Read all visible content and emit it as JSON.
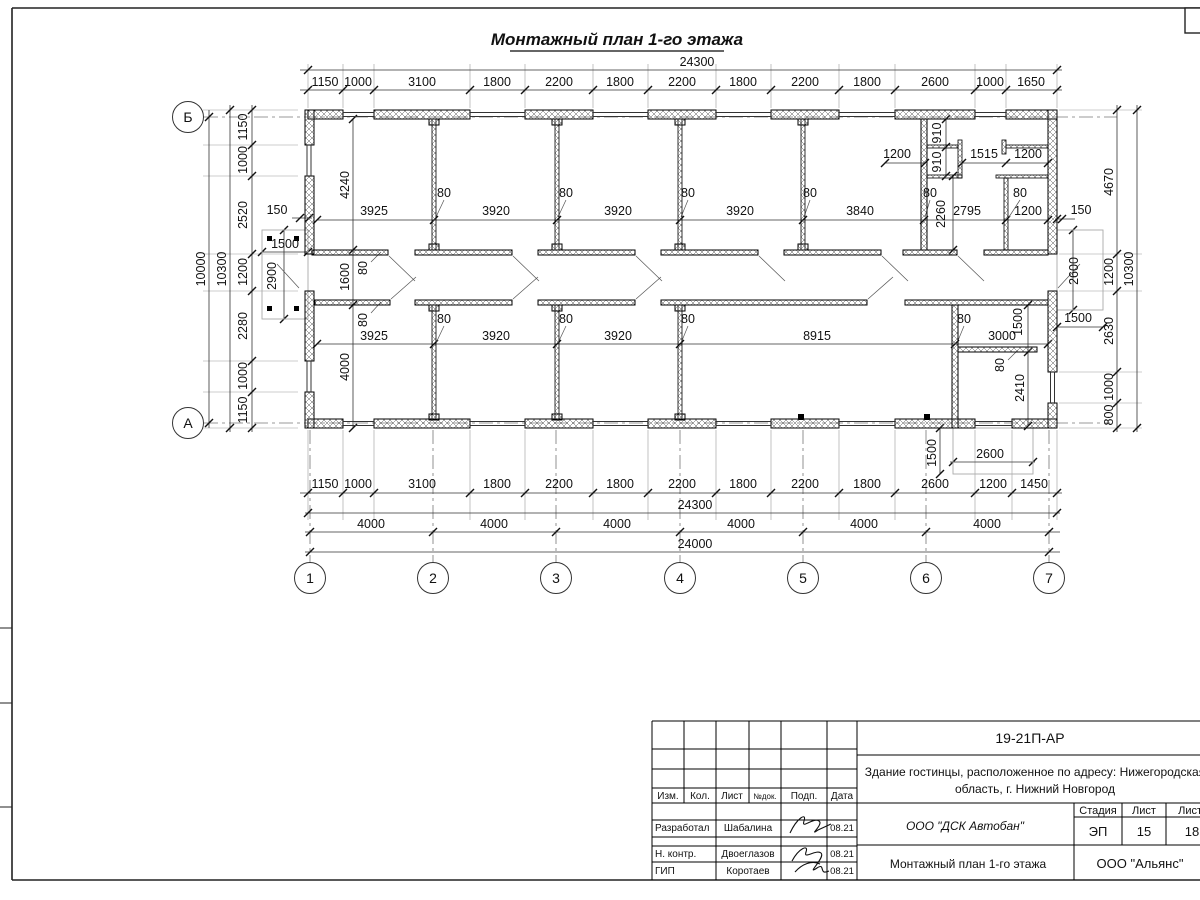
{
  "title": "Монтажный план 1-го этажа",
  "axes": {
    "cols": [
      "1",
      "2",
      "3",
      "4",
      "5",
      "6",
      "7"
    ],
    "rows": [
      "Б",
      "А"
    ]
  },
  "dims": {
    "labels": [
      {
        "t": "24300",
        "x": 697,
        "y": 66
      },
      {
        "t": "1150",
        "x": 325,
        "y": 86
      },
      {
        "t": "1000",
        "x": 358,
        "y": 86
      },
      {
        "t": "3100",
        "x": 422,
        "y": 86
      },
      {
        "t": "1800",
        "x": 497,
        "y": 86
      },
      {
        "t": "2200",
        "x": 559,
        "y": 86
      },
      {
        "t": "1800",
        "x": 620,
        "y": 86
      },
      {
        "t": "2200",
        "x": 682,
        "y": 86
      },
      {
        "t": "1800",
        "x": 743,
        "y": 86
      },
      {
        "t": "2200",
        "x": 805,
        "y": 86
      },
      {
        "t": "1800",
        "x": 867,
        "y": 86
      },
      {
        "t": "2600",
        "x": 935,
        "y": 86
      },
      {
        "t": "1000",
        "x": 990,
        "y": 86
      },
      {
        "t": "1650",
        "x": 1031,
        "y": 86
      },
      {
        "t": "1150",
        "x": 325,
        "y": 488
      },
      {
        "t": "1000",
        "x": 358,
        "y": 488
      },
      {
        "t": "3100",
        "x": 422,
        "y": 488
      },
      {
        "t": "1800",
        "x": 497,
        "y": 488
      },
      {
        "t": "2200",
        "x": 559,
        "y": 488
      },
      {
        "t": "1800",
        "x": 620,
        "y": 488
      },
      {
        "t": "2200",
        "x": 682,
        "y": 488
      },
      {
        "t": "1800",
        "x": 743,
        "y": 488
      },
      {
        "t": "2200",
        "x": 805,
        "y": 488
      },
      {
        "t": "1800",
        "x": 867,
        "y": 488
      },
      {
        "t": "2600",
        "x": 935,
        "y": 488
      },
      {
        "t": "1200",
        "x": 993,
        "y": 488
      },
      {
        "t": "1450",
        "x": 1034,
        "y": 488
      },
      {
        "t": "24300",
        "x": 695,
        "y": 509
      },
      {
        "t": "4000",
        "x": 371,
        "y": 528
      },
      {
        "t": "4000",
        "x": 494,
        "y": 528
      },
      {
        "t": "4000",
        "x": 617,
        "y": 528
      },
      {
        "t": "4000",
        "x": 741,
        "y": 528
      },
      {
        "t": "4000",
        "x": 864,
        "y": 528
      },
      {
        "t": "4000",
        "x": 987,
        "y": 528
      },
      {
        "t": "24000",
        "x": 695,
        "y": 548
      },
      {
        "t": "1150",
        "x": 247,
        "y": 127,
        "r": 1
      },
      {
        "t": "1000",
        "x": 247,
        "y": 160,
        "r": 1
      },
      {
        "t": "2520",
        "x": 247,
        "y": 215,
        "r": 1
      },
      {
        "t": "1200",
        "x": 247,
        "y": 272,
        "r": 1
      },
      {
        "t": "2280",
        "x": 247,
        "y": 326,
        "r": 1
      },
      {
        "t": "1000",
        "x": 247,
        "y": 376,
        "r": 1
      },
      {
        "t": "1150",
        "x": 247,
        "y": 410,
        "r": 1
      },
      {
        "t": "10300",
        "x": 226,
        "y": 269,
        "r": 1
      },
      {
        "t": "10000",
        "x": 205,
        "y": 269,
        "r": 1
      },
      {
        "t": "4670",
        "x": 1113,
        "y": 182,
        "r": 1
      },
      {
        "t": "1200",
        "x": 1113,
        "y": 272,
        "r": 1
      },
      {
        "t": "2630",
        "x": 1113,
        "y": 331,
        "r": 1
      },
      {
        "t": "1000",
        "x": 1113,
        "y": 387,
        "r": 1
      },
      {
        "t": "800",
        "x": 1113,
        "y": 415,
        "r": 1
      },
      {
        "t": "10300",
        "x": 1133,
        "y": 269,
        "r": 1
      },
      {
        "t": "4240",
        "x": 349,
        "y": 185,
        "r": 1
      },
      {
        "t": "3925",
        "x": 374,
        "y": 215
      },
      {
        "t": "80",
        "x": 444,
        "y": 197
      },
      {
        "t": "3920",
        "x": 496,
        "y": 215
      },
      {
        "t": "80",
        "x": 566,
        "y": 197
      },
      {
        "t": "3920",
        "x": 618,
        "y": 215
      },
      {
        "t": "80",
        "x": 688,
        "y": 197
      },
      {
        "t": "3920",
        "x": 740,
        "y": 215
      },
      {
        "t": "80",
        "x": 810,
        "y": 197
      },
      {
        "t": "3840",
        "x": 860,
        "y": 215
      },
      {
        "t": "80",
        "x": 930,
        "y": 197
      },
      {
        "t": "1600",
        "x": 349,
        "y": 277,
        "r": 1
      },
      {
        "t": "80",
        "x": 367,
        "y": 268,
        "r": 1
      },
      {
        "t": "80",
        "x": 367,
        "y": 320,
        "r": 1
      },
      {
        "t": "1200",
        "x": 897,
        "y": 158
      },
      {
        "t": "910",
        "x": 941,
        "y": 133,
        "r": 1
      },
      {
        "t": "910",
        "x": 941,
        "y": 162,
        "r": 1
      },
      {
        "t": "1515",
        "x": 984,
        "y": 158
      },
      {
        "t": "1200",
        "x": 1028,
        "y": 158
      },
      {
        "t": "2260",
        "x": 945,
        "y": 214,
        "r": 1
      },
      {
        "t": "2795",
        "x": 967,
        "y": 215
      },
      {
        "t": "80",
        "x": 1020,
        "y": 197
      },
      {
        "t": "1200",
        "x": 1028,
        "y": 215
      },
      {
        "t": "150",
        "x": 1081,
        "y": 214
      },
      {
        "t": "3925",
        "x": 374,
        "y": 340
      },
      {
        "t": "80",
        "x": 444,
        "y": 323
      },
      {
        "t": "3920",
        "x": 496,
        "y": 340
      },
      {
        "t": "80",
        "x": 566,
        "y": 323
      },
      {
        "t": "3920",
        "x": 618,
        "y": 340
      },
      {
        "t": "80",
        "x": 688,
        "y": 323
      },
      {
        "t": "8915",
        "x": 817,
        "y": 340
      },
      {
        "t": "80",
        "x": 964,
        "y": 323
      },
      {
        "t": "3000",
        "x": 1002,
        "y": 340
      },
      {
        "t": "4000",
        "x": 349,
        "y": 367,
        "r": 1
      },
      {
        "t": "1500",
        "x": 1022,
        "y": 322,
        "r": 1
      },
      {
        "t": "80",
        "x": 1004,
        "y": 365,
        "r": 1
      },
      {
        "t": "2410",
        "x": 1024,
        "y": 388,
        "r": 1
      },
      {
        "t": "150",
        "x": 277,
        "y": 214
      },
      {
        "t": "1500",
        "x": 285,
        "y": 248
      },
      {
        "t": "2900",
        "x": 276,
        "y": 276,
        "r": 1
      },
      {
        "t": "1500",
        "x": 936,
        "y": 453,
        "r": 1
      },
      {
        "t": "2600",
        "x": 990,
        "y": 458
      },
      {
        "t": "2600",
        "x": 1078,
        "y": 271,
        "r": 1
      },
      {
        "t": "1500",
        "x": 1078,
        "y": 322
      }
    ]
  },
  "stamp": {
    "code": "19-21П-АР",
    "object_line1": "Здание гостинцы, расположенное по адресу: Нижегородская",
    "object_line2": "область, г. Нижний Новгород",
    "org": "ООО \"ДСК Автобан\"",
    "doc_title": "Монтажный план 1-го этажа",
    "company": "ООО \"Альянс\"",
    "header": {
      "izm": "Изм.",
      "kol": "Кол.",
      "list": "Лист",
      "ndok": "№док.",
      "podp": "Подп.",
      "data": "Дата"
    },
    "stage_label": "Стадия",
    "sheet_label": "Лист",
    "sheets_label": "Листов",
    "stage": "ЭП",
    "sheet": "15",
    "sheets": "18",
    "people": [
      {
        "role": "Разработал",
        "name": "Шабалина",
        "date": "08.21"
      },
      {
        "role": "Н. контр.",
        "name": "Двоеглазов",
        "date": "08.21"
      },
      {
        "role": "ГИП",
        "name": "Коротаев",
        "date": "08.21"
      }
    ]
  }
}
